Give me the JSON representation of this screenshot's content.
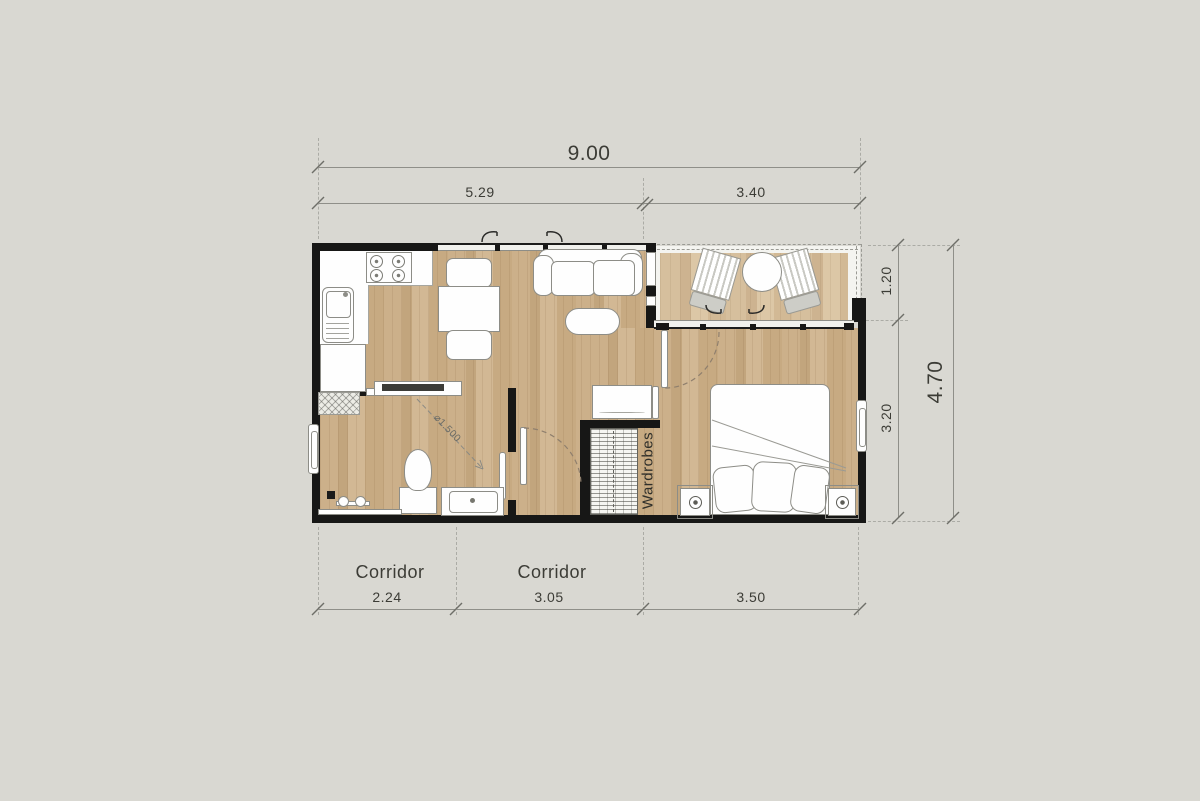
{
  "dimensions": {
    "top_total": "9.00",
    "top_left": "5.29",
    "top_right": "3.40",
    "bottom_left": "2.24",
    "bottom_middle": "3.05",
    "bottom_right": "3.50",
    "right_total": "4.70",
    "right_upper": "1.20",
    "right_lower": "3.20"
  },
  "labels": {
    "corridor_left": "Corridor",
    "corridor_middle": "Corridor",
    "wardrobes": "Wardrobes",
    "turning_circle": "⌀1.500"
  },
  "colors": {
    "background": "#d9d8d2",
    "wall": "#171716",
    "floor_wood": "#c9ac84",
    "balcony_wood": "#d4bd9b",
    "dimension_line": "#8f8f89",
    "text": "#3c3c36"
  }
}
